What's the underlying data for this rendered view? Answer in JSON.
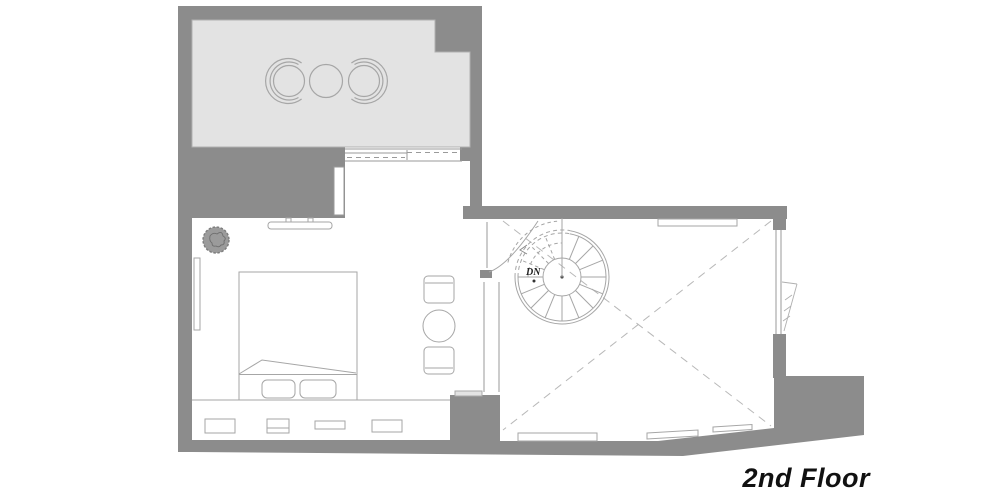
{
  "plan": {
    "floor_label": "2nd Floor",
    "stair": {
      "direction_label": "DN"
    },
    "colors": {
      "wall": "#8c8c8c",
      "terrace_floor": "#e3e3e3",
      "furniture_line": "#a6a6a6",
      "light_line": "#b8b8b8",
      "text": "#111111"
    },
    "furniture_icons": [
      "terrace-armchair-left-icon",
      "terrace-round-table-icon",
      "terrace-armchair-right-icon",
      "sliding-door-icon",
      "tv-icon",
      "potted-plant-icon",
      "wardrobe-icon",
      "double-bed-icon",
      "pillow-icon",
      "side-chair-icon",
      "round-side-table-icon",
      "storage-drawers-icon",
      "swing-door-icon",
      "spiral-staircase-icon",
      "void-cross-icon",
      "casement-window-icon"
    ]
  }
}
